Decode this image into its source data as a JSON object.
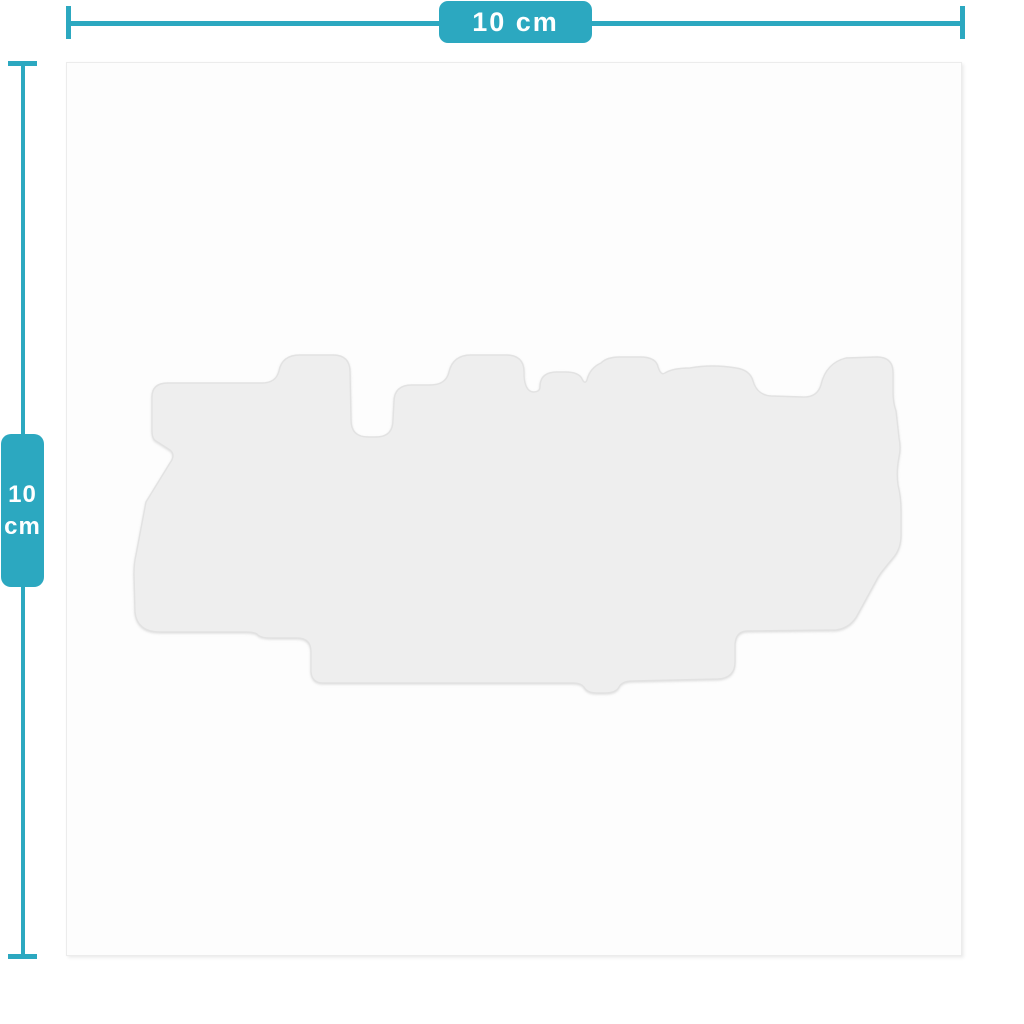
{
  "measurements": {
    "width": {
      "label": "10 cm"
    },
    "height": {
      "value": "10",
      "unit": "cm"
    }
  },
  "colors": {
    "accent_teal": "#2ca8c0",
    "card_bg": "#fdfdfd",
    "card_border": "#ececec",
    "sticker_fill": "#eeeeee",
    "sticker_edge": "#e2e2e2",
    "page_bg": "#ffffff",
    "badge_text": "#ffffff"
  },
  "sticker": {
    "description": "faint die-cut sticker silhouette",
    "path": "M 152 401 L 152 397 Q 152 383 168 383 L 262 383 Q 276 383 279 371 Q 282 355 300 355 L 333 355 Q 350 355 350 372 L 351 420 Q 351 437 368 437 L 376 437 Q 393 437 393 420 L 394 402 Q 394 385 412 385 L 430 385 Q 446 385 449 372 Q 453 355 471 355 L 506 355 Q 524 355 524 372 L 524 376 Q 525 391 533 392 Q 540 392 540 387 Q 540 372 557 372 L 565 372 Q 579 372 582 379 Q 585 385 587 380 Q 590 368 601 363 Q 607 357 620 357 L 640 357 Q 656 357 658 367 Q 661 376 665 373 Q 673 368 690 368 Q 712 364 736 368 Q 750 370 753 381 Q 757 395 771 396 L 802 397 Q 817 398 821 385 Q 826 363 846 358 L 877 357 Q 893 357 893 373 L 893 392 Q 893 403 896 411 L 899 438 Q 901 448 899 457 Q 896 472 898 485 Q 901 497 901 511 L 901 535 Q 901 549 893 558 L 884 569 Q 879 575 876 581 L 858 614 Q 851 628 836 630 L 748 631 Q 736 631 735 644 L 735 662 Q 735 678 718 679 L 633 681 Q 622 681 619 687 Q 616 693 605 693 L 597 693 Q 587 693 584 687 Q 581 683 573 683 L 323 683 Q 312 683 311 672 L 311 652 Q 311 638 297 638 L 271 638 Q 260 638 257 634 Q 254 632 245 632 L 160 632 Q 137 632 135 612 L 134 574 Q 134 563 136 555 L 146 502 L 170 463 Q 176 455 170 450 L 156 441 Q 152 439 152 430 Z"
  }
}
